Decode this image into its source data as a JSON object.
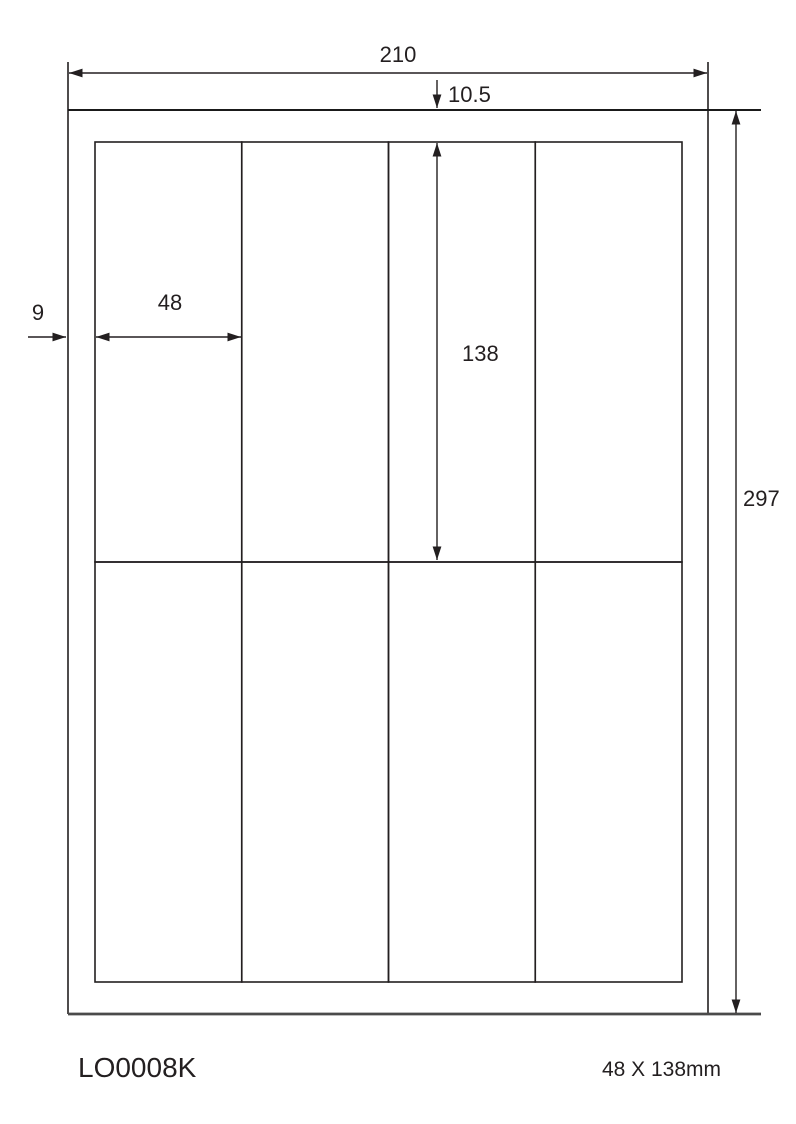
{
  "diagram": {
    "title_semantic": "label-sheet-dimension-diagram",
    "colors": {
      "background": "#ffffff",
      "line": "#231f20",
      "bottom_edge_line": "#4a4a4a"
    },
    "sheet_grid": {
      "columns": 4,
      "rows": 2,
      "cell_count": 8
    },
    "dimensions": {
      "page_width_mm": "210",
      "page_height_mm": "297",
      "top_margin_mm": "10.5",
      "side_margin_mm": "9",
      "label_width_mm": "48",
      "label_height_mm": "138"
    },
    "footer": {
      "product_code": "LO0008K",
      "label_size": "48 X 138mm"
    }
  }
}
